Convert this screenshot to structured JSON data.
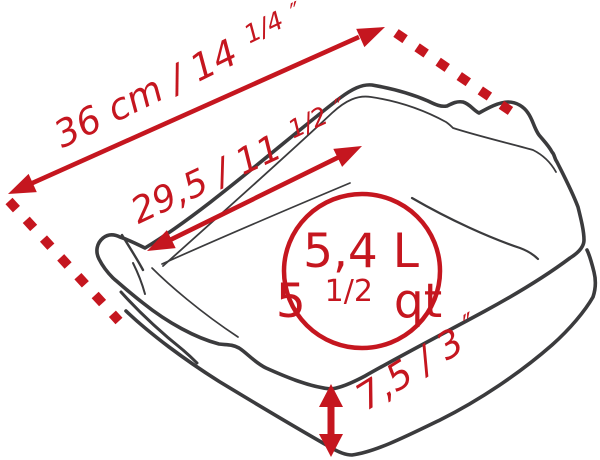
{
  "figure": {
    "type": "product-dimension-diagram",
    "subject": "square ceramic baking dish with two corner handles, three-quarter perspective line drawing",
    "colors": {
      "accent_red": "#c5161f",
      "outline_dark": "#3b3b3d",
      "background": "#ffffff"
    },
    "dimensions": {
      "outer_diagonal": {
        "text": "36 cm / 14",
        "fraction": "1/4",
        "prime": "″"
      },
      "inner_diagonal": {
        "text": "29,5 / 11",
        "fraction": "1/2",
        "prime": "″"
      },
      "height": {
        "text": "7,5 / 3",
        "prime": "″"
      }
    },
    "capacity": {
      "line1": "5,4 L",
      "line2_whole": "5",
      "line2_fraction": "1/2",
      "line2_unit": "qt"
    }
  }
}
